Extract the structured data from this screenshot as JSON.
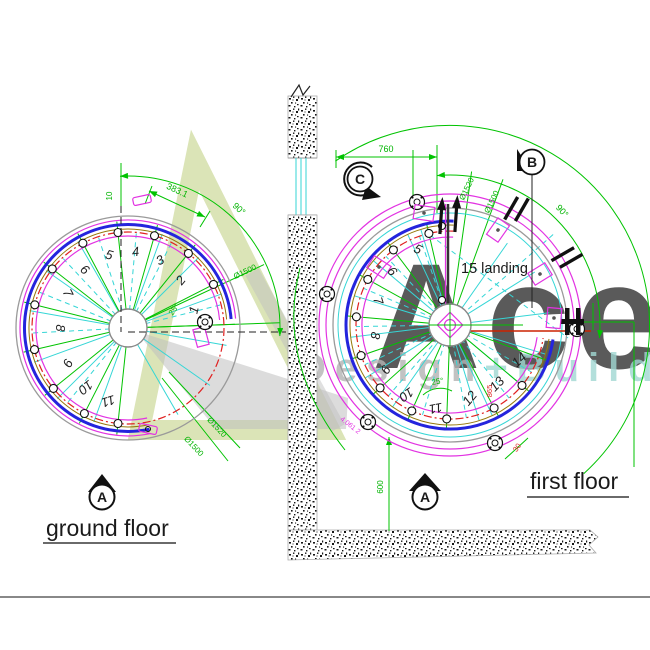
{
  "watermark": {
    "brand": "Ace",
    "tagline_left": "Design",
    "tagline_right": "+Build",
    "brand_color": "#c3d48c",
    "tagline_color": "#a6a6a6",
    "tagline_accent_color": "#8fd0ca"
  },
  "colors": {
    "dimension_green": "#00c300",
    "handrail_blue": "#2424dd",
    "rail_magenta": "#e233e2",
    "walkline_red": "#e02020",
    "opening_cyan": "#35d6d6"
  },
  "ground_floor": {
    "title": "ground floor",
    "north_marker": "A",
    "steps": [
      "1",
      "2",
      "3",
      "4",
      "5",
      "6",
      "7",
      "8",
      "9",
      "10",
      "11"
    ],
    "dims": {
      "tread_width": "383.1",
      "sweep_angle": "90°",
      "step_angle": "25°",
      "offset_10": "10",
      "dia_inner_ur": "Ø1500",
      "dia_outer_lr": "Ø1520",
      "dia_inner_lr": "Ø1500"
    }
  },
  "first_floor": {
    "title": "first floor",
    "north_marker": "A",
    "section_marker_b": "B",
    "section_marker_c": "C",
    "landing_label": "15 landing",
    "steps": [
      "5",
      "6",
      "7",
      "8",
      "9",
      "10",
      "11",
      "12",
      "13",
      "14"
    ],
    "dims": {
      "top_width": "760",
      "sweep_angle": "90°",
      "step_angle": "25°",
      "wall_offset": "600",
      "dia_outer": "Ø1520",
      "dia_inner": "Ø1500",
      "radius_865": "865",
      "offset_30": "30",
      "level_mark": "4.061 2"
    }
  }
}
